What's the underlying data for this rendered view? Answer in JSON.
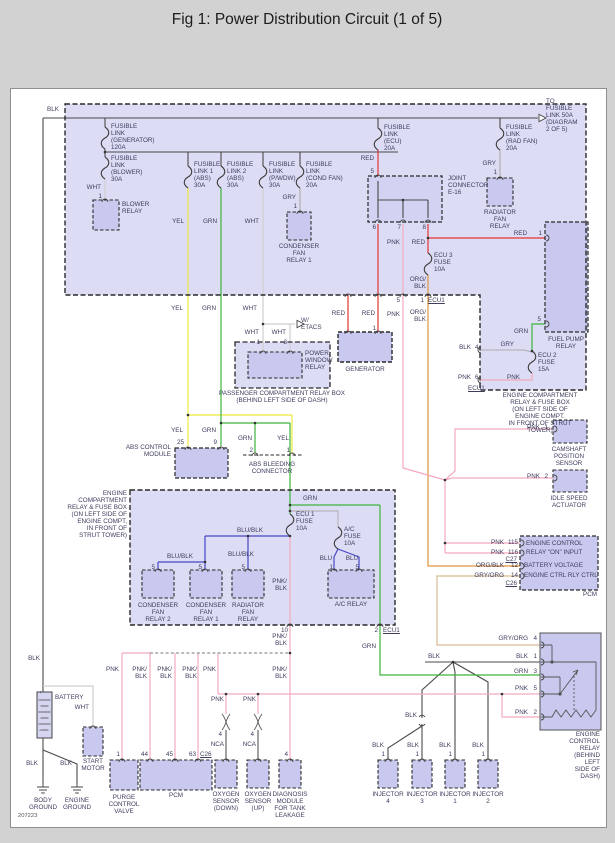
{
  "title": "Fig 1: Power Distribution Circuit (1 of 5)",
  "doc_number": "207223",
  "colors": {
    "background": "#d2d2d2",
    "box_fill": "#dcdcf5",
    "relay_fill": "#c9c9ef",
    "wire_blk": "#4a4a4a",
    "wire_wht": "#cfcfcf",
    "wire_yel": "#ece83a",
    "wire_grn": "#3cb43c",
    "wire_red": "#e23434",
    "wire_pnk": "#f3a9bd",
    "wire_blu": "#4747c9",
    "wire_org": "#e0953e",
    "wire_tan": "#d6bc92",
    "wire_gry": "#ababab"
  },
  "t": {
    "blk": "BLK",
    "wht": "WHT",
    "yel": "YEL",
    "grn": "GRN",
    "red": "RED",
    "gry": "GRY",
    "pnk": "PNK",
    "blu": "BLU",
    "blublk": "BLU/BLK",
    "pnkblk": "PNK/\nBLK",
    "orgblk": "ORG/\nBLK",
    "orgblk1": "ORG/BLK",
    "gryorg": "GRY/ORG",
    "ecu1": "ECU1",
    "nca": "NCA",
    "n1": "1",
    "n2": "2",
    "n3": "3",
    "n4": "4",
    "n5": "5",
    "n6": "6",
    "n7": "7",
    "n8": "8",
    "n9": "9",
    "n10": "10",
    "n12": "12",
    "n14": "14",
    "n25": "25",
    "n44": "44",
    "n45": "45",
    "n63": "63",
    "n115": "115",
    "n116": "116",
    "c26": "C26",
    "c27": "C27",
    "plus": "+",
    "minus": "-",
    "to_link": "TO\nFUSIBLE\nLINK 50A\n(DIAGRAM\n2 OF 5)",
    "fl_gen": "FUSIBLE\nLINK\n(GENERATOR)\n120A",
    "fl_blower": "FUSIBLE\nLINK\n(BLOWER)\n30A",
    "fl_abs1": "FUSIBLE\nLINK 1\n(ABS)\n30A",
    "fl_abs2": "FUSIBLE\nLINK 2\n(ABS)\n30A",
    "fl_pwdw": "FUSIBLE\nLINK\n(P/WDW)\n30A",
    "fl_condfan": "FUSIBLE\nLINK\n(COND FAN)\n20A",
    "fl_ecu": "FUSIBLE\nLINK\n(ECU)\n20A",
    "fl_radfan": "FUSIBLE\nLINK\n(RAD FAN)\n20A",
    "blower_relay": "BLOWER\nRELAY",
    "cond_relay1": "CONDENSER\nFAN\nRELAY 1",
    "rad_relay": "RADIATOR\nFAN\nRELAY",
    "joint": "JOINT\nCONNECTOR\nE-16",
    "ecu3_fuse": "ECU 3\nFUSE\n10A",
    "ecu2_fuse": "ECU 2\nFUSE\n15A",
    "ecu1_fuse": "ECU 1\nFUSE\n10A",
    "ac_fuse": "A/C\nFUSE\n10A",
    "fuel_pump": "FUEL PUMP\nRELAY",
    "box1": "ENGINE COMPARTMENT RELAY & FUSE BOX\n(ON LEFT SIDE OF ENGINE COMPT.\nIN FRONT OF STRUT TOWER)",
    "box2": "ENGINE\nCOMPARTMENT\nRELAY & FUSE BOX\n(ON LEFT SIDE OF\nENGINE COMPT,\nIN FRONT OF\nSTRUT TOWER)",
    "wetacs": "W/\nETACS",
    "pwr": "POWER\nWINDOW\nRELAY",
    "passbox": "PASSENGER COMPARTMENT RELAY BOX\n(BEHIND LEFT SIDE OF DASH)",
    "generator": "GENERATOR",
    "absmod": "ABS CONTROL\nMODULE",
    "absbleed": "ABS BLEEDING\nCONNECTOR",
    "cond_relay2": "CONDENSER\nFAN\nRELAY 2",
    "cond_relay1b": "CONDENSER\nFAN\nRELAY 1",
    "rad_relay2": "RADIATOR\nFAN\nRELAY",
    "ac_relay": "A/C RELAY",
    "camshaft": "CAMSHAFT\nPOSITION\nSENSOR",
    "idle": "IDLE SPEED\nACTUATOR",
    "pcm_l1": "ENGINE CONTROL",
    "pcm_l2": "RELAY \"ON\" INPUT",
    "pcm_l3": "BATTERY VOLTAGE",
    "pcm_l4": "ENGINE CTRL RLY CTRL",
    "pcm": "PCM",
    "ecr": "ENGINE CONTROL\nRELAY\n(BEHIND LEFT\nSIDE OF DASH)",
    "battery": "BATTERY",
    "start_motor": "START\nMOTOR",
    "body_gnd": "BODY\nGROUND",
    "eng_gnd": "ENGINE\nGROUND",
    "purge": "PURGE\nCONTROL\nVALVE",
    "ox_down": "OXYGEN\nSENSOR\n(DOWN)",
    "ox_up": "OXYGEN\nSENSOR\n(UP)",
    "diag": "DIAGNOSIS\nMODULE\nFOR TANK\nLEAKAGE",
    "inj4": "INJECTOR\n4",
    "inj3": "INJECTOR\n3",
    "inj1": "INJECTOR\n1",
    "inj2": "INJECTOR\n2"
  }
}
